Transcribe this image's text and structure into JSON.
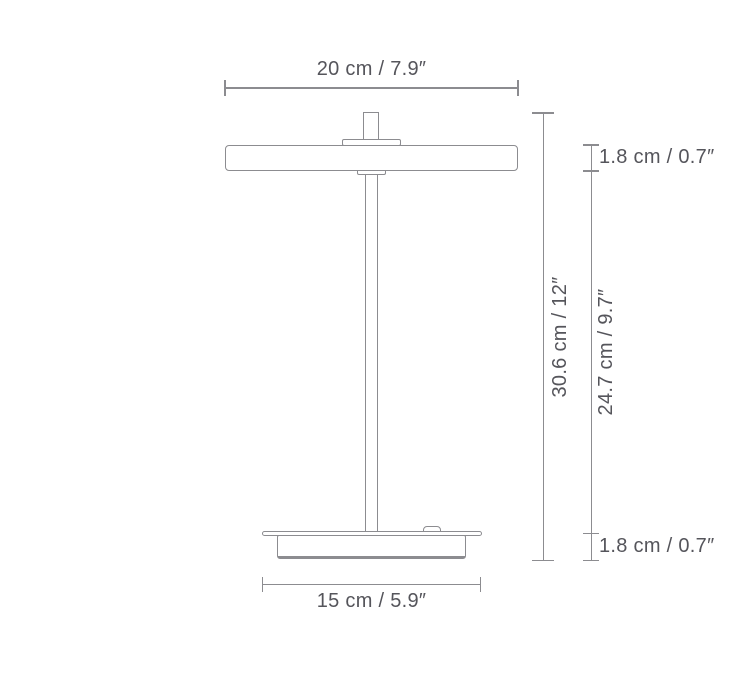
{
  "diagram": {
    "subject": "table-lamp-dimension-drawing",
    "labels": {
      "shade_width": "20 cm / 7.9″",
      "shade_thickness": "1.8 cm / 0.7″",
      "total_height": "30.6 cm / 12″",
      "stem_height": "24.7 cm / 9.7″",
      "base_thickness": "1.8 cm / 0.7″",
      "base_width": "15 cm / 5.9″"
    },
    "colors": {
      "background": "#ffffff",
      "outline": "#8c8c90",
      "text": "#55555b"
    }
  }
}
